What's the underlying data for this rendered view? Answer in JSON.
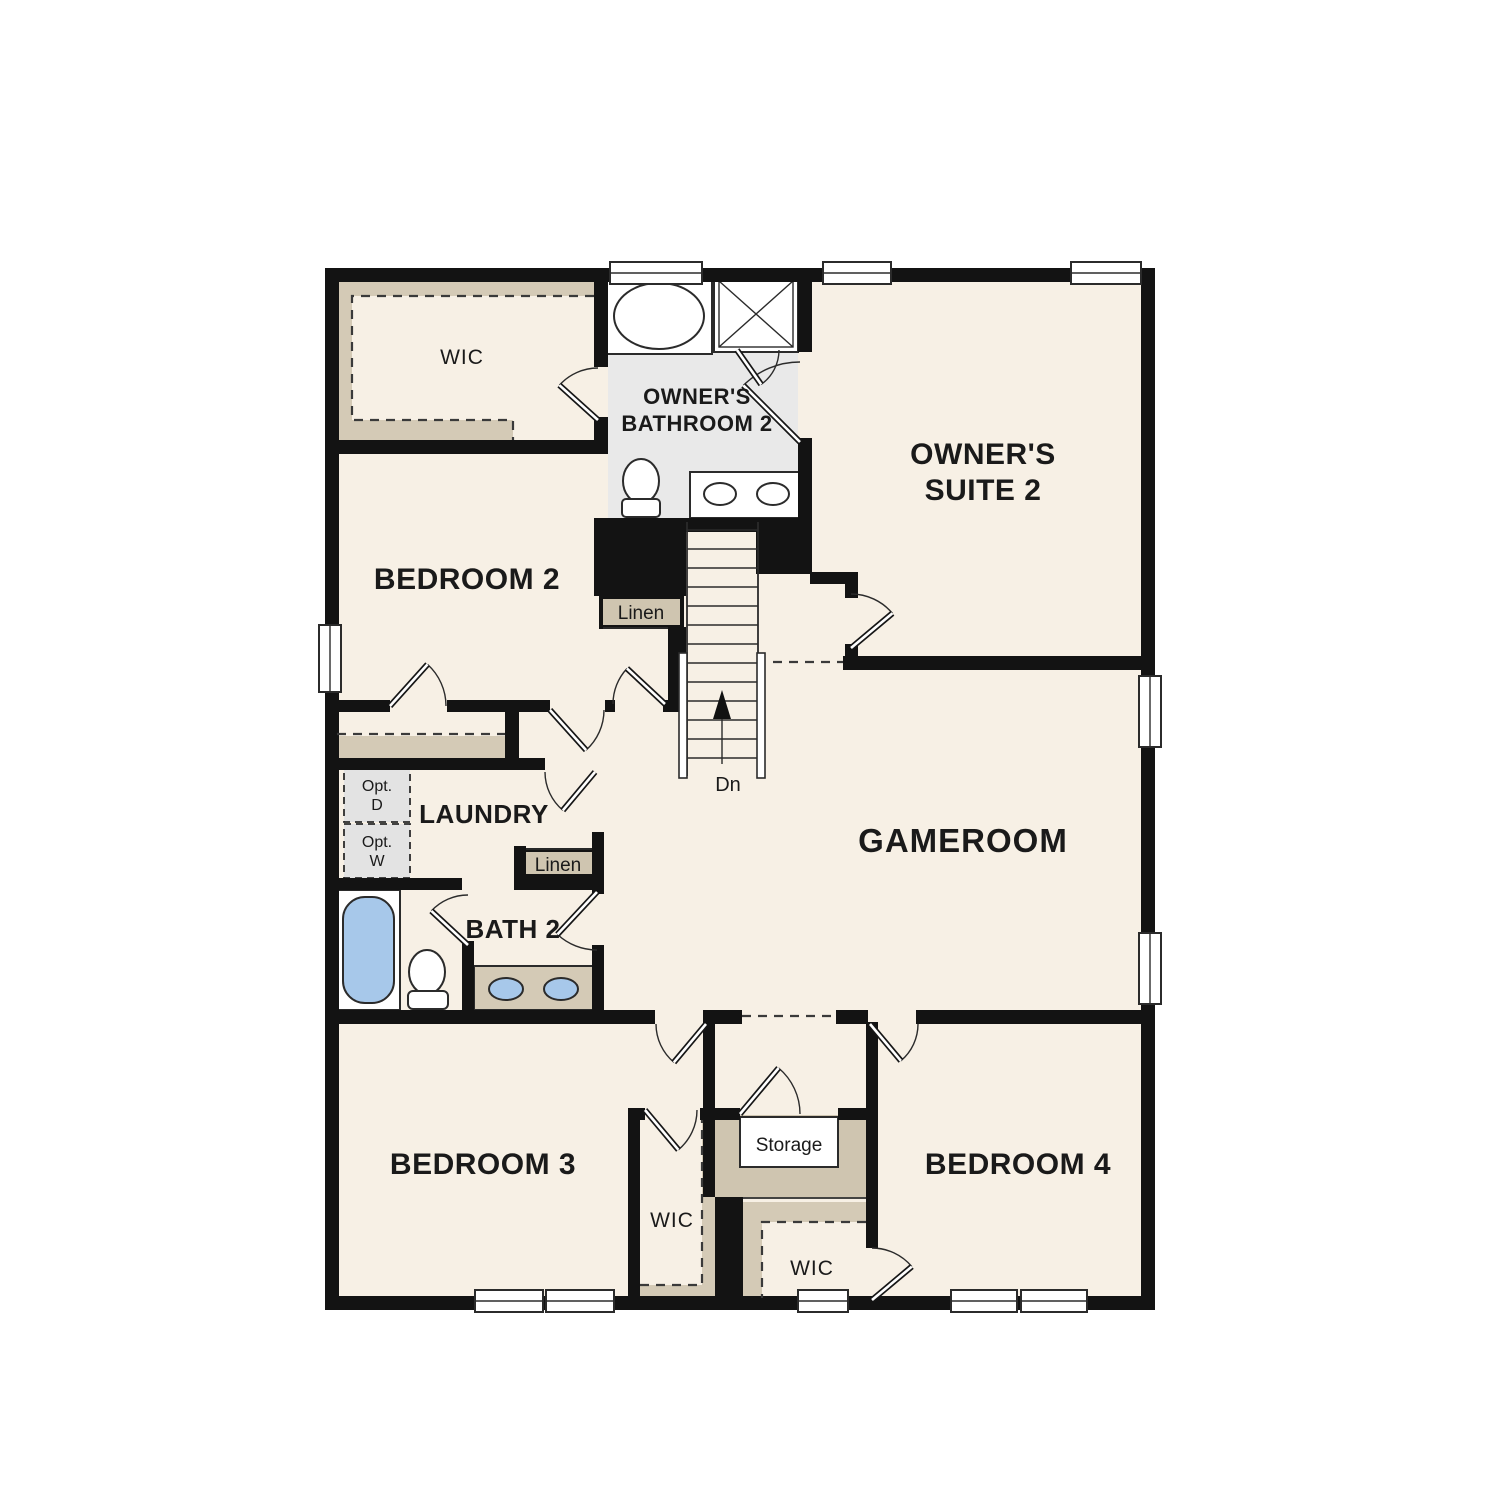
{
  "labels": {
    "wic_top": "WIC",
    "owners_bath_l1": "OWNER'S",
    "owners_bath_l2": "BATHROOM 2",
    "owners_suite_l1": "OWNER'S",
    "owners_suite_l2": "SUITE 2",
    "bedroom2": "BEDROOM 2",
    "linen_upper": "Linen",
    "laundry": "LAUNDRY",
    "opt_d_l1": "Opt.",
    "opt_d_l2": "D",
    "opt_w_l1": "Opt.",
    "opt_w_l2": "W",
    "linen_lower": "Linen",
    "bath2": "BATH 2",
    "dn": "Dn",
    "gameroom": "GAMEROOM",
    "bedroom3": "BEDROOM 3",
    "bedroom4": "BEDROOM 4",
    "wic_bedroom3": "WIC",
    "wic_bedroom4": "WIC",
    "storage": "Storage"
  },
  "colors": {
    "floor": "#f7f0e5",
    "shelf_tan": "#d4cab6",
    "closet_tan": "#cfc5b0",
    "bathroom_gray": "#e9e9e9",
    "appliance_gray": "#e3e3e3",
    "fixture_blue": "#a7c8ea",
    "wall": "#131313",
    "text": "#1a1a1a"
  }
}
